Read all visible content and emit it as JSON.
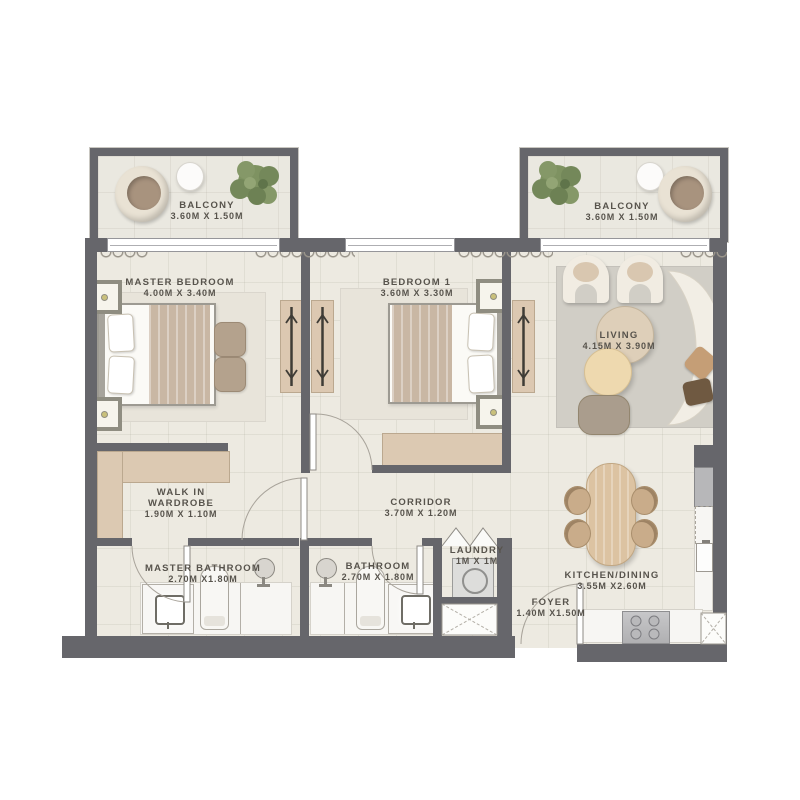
{
  "rooms": {
    "balcony_left": {
      "name": "BALCONY",
      "dims": "3.60M X 1.50M"
    },
    "balcony_right": {
      "name": "BALCONY",
      "dims": "3.60M X 1.50M"
    },
    "master_bedroom": {
      "name": "MASTER BEDROOM",
      "dims": "4.00M X 3.40M"
    },
    "bedroom_1": {
      "name": "BEDROOM 1",
      "dims": "3.60M X 3.30M"
    },
    "living": {
      "name": "LIVING",
      "dims": "4.15M X 3.90M"
    },
    "walk_in_wardrobe": {
      "name_line_1": "WALK IN",
      "name_line_2": "WARDROBE",
      "dims": "1.90M X 1.10M"
    },
    "corridor": {
      "name": "CORRIDOR",
      "dims": "3.70M X 1.20M"
    },
    "laundry": {
      "name": "LAUNDRY",
      "dims": "1M X 1M"
    },
    "master_bathroom": {
      "name": "MASTER BATHROOM",
      "dims": "2.70M X1.80M"
    },
    "bathroom": {
      "name": "BATHROOM",
      "dims": "2.70M X 1.80M"
    },
    "kitchen_dining": {
      "name": "KITCHEN/DINING",
      "dims": "3.55M X2.60M"
    },
    "foyer": {
      "name": "FOYER",
      "dims": "1.40M X1.50M"
    }
  },
  "colors": {
    "wall": "#66666b",
    "floor": "#edeae1",
    "wood_accent": "#dcc8b1",
    "label_text": "#57534c",
    "greenery": "#7e9261",
    "living_rug": "#d1cec6"
  }
}
